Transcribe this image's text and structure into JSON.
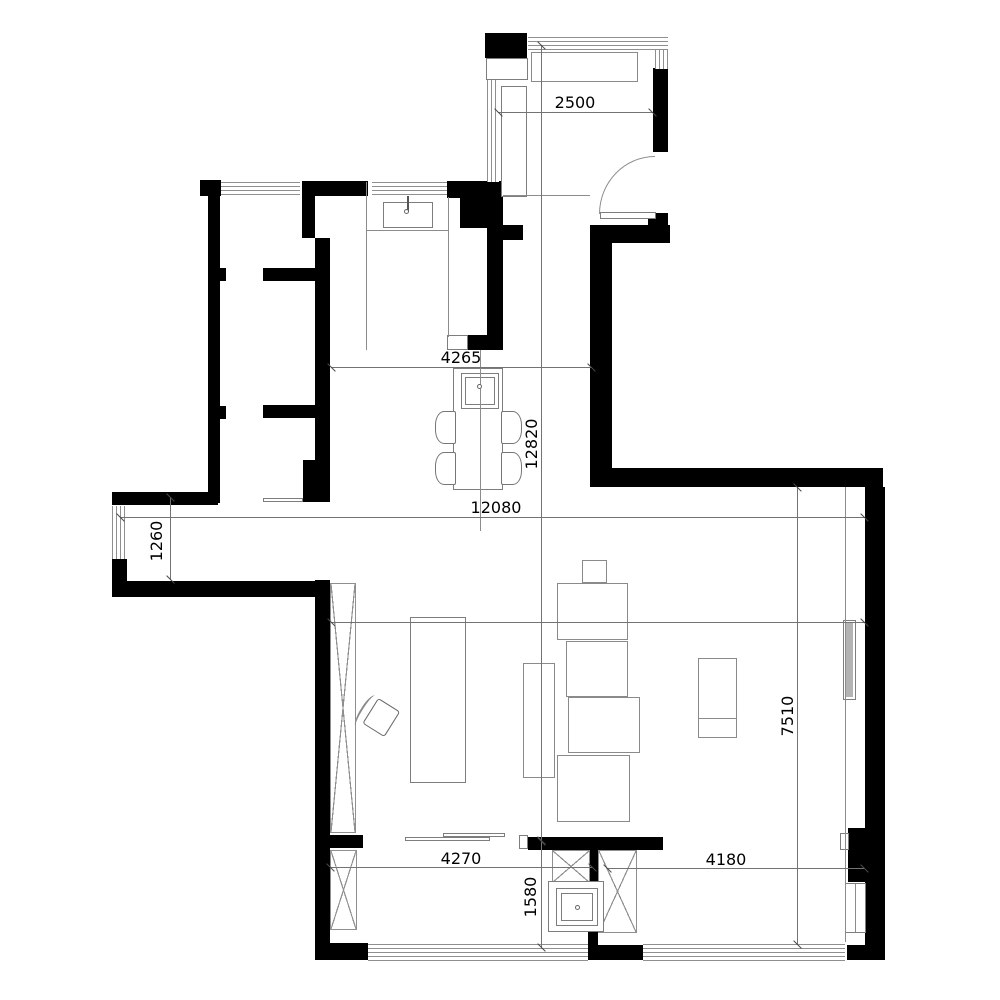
{
  "plan": {
    "type": "apartment-floor-plan",
    "colors": {
      "wall": "#000000",
      "line": "#8c8c8c",
      "dimension_text": "#000000"
    },
    "dimensions_mm": {
      "d2500": "2500",
      "d4265": "4265",
      "d12820": "12820",
      "d12080": "12080",
      "d1260": "1260",
      "d8770": "8770",
      "d7510": "7510",
      "d4270": "4270",
      "d4180": "4180",
      "d1580": "1580"
    },
    "furniture": [
      "entry-wardrobe",
      "entry-cabinet",
      "kitchen-sink",
      "island-cooktop-table",
      "dining-chairs",
      "tall-cabinet-x",
      "desk",
      "lounge-chair",
      "sofa-set",
      "side-table",
      "wall-tv",
      "shelf",
      "washing-machine"
    ]
  }
}
